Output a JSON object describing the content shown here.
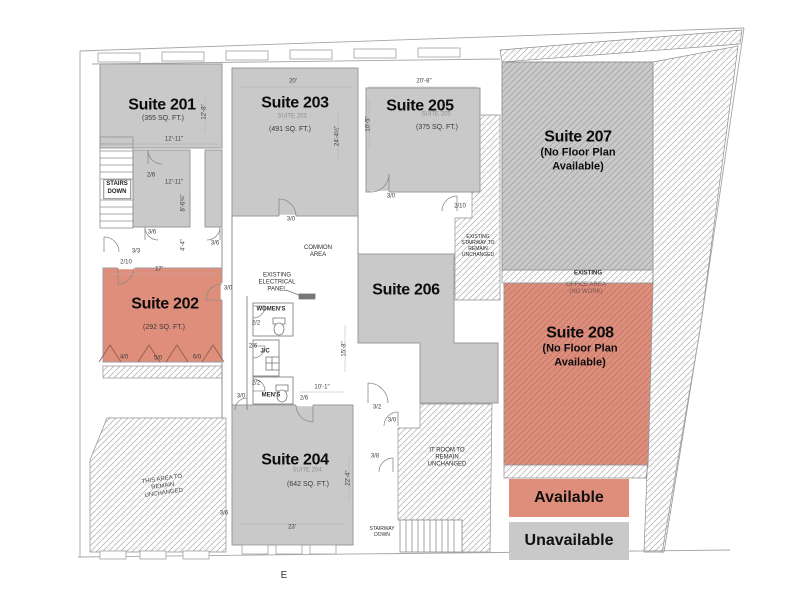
{
  "legend": {
    "available": "Available",
    "unavailable": "Unavailable"
  },
  "colors": {
    "available": "#E08E7C",
    "unavailable": "#C9C9C9"
  },
  "suites": {
    "s201": {
      "name": "Suite 201",
      "sqft": "(355 SQ. FT.)"
    },
    "s202": {
      "name": "Suite 202",
      "sqft": "(292 SQ. FT.)"
    },
    "s203": {
      "name": "Suite 203",
      "sub": "SUITE 203",
      "sqft": "(491 SQ. FT.)"
    },
    "s204": {
      "name": "Suite 204",
      "sub": "SUITE 204",
      "sqft": "(642 SQ. FT.)"
    },
    "s205": {
      "name": "Suite 205",
      "sub": "SUITE 205",
      "sqft": "(375 SQ. FT.)"
    },
    "s206": {
      "name": "Suite 206"
    },
    "s207": {
      "name": "Suite 207",
      "note": "(No Floor Plan\nAvailable)"
    },
    "s208": {
      "name": "Suite 208",
      "note": "(No Floor Plan\nAvailable)"
    }
  },
  "annotations": {
    "common_area": "COMMON\nAREA",
    "electrical_panel": "EXISTING\nELECTRICAL\nPANEL",
    "womens": "WOMEN'S",
    "janitor_closet": "J/C",
    "mens": "MEN'S",
    "stairs_down": "STAIRS\nDOWN",
    "existing_stairway": "EXISTING\nSTAIRWAY TO\nREMAIN\nUNCHANGED",
    "existing_label": "EXISTING",
    "office_area": "OFFICE AREA\n(NO WORK)",
    "it_room": "IT ROOM TO\nREMAIN\nUNCHANGED",
    "area_unchanged": "THIS AREA TO\nREMAIN\nUNCHANGED",
    "stairway_down": "STAIRWAY\nDOWN",
    "east_marker": "E"
  },
  "dims": {
    "d1": "12'-8\"",
    "d2": "12'-11\"",
    "d3": "2/6",
    "d4": "12'-11\"",
    "d5": "8'-6¾\"",
    "d6": "3/6",
    "d7": "4'-4\"",
    "d8": "3/6",
    "d9": "3/3",
    "d10": "20'",
    "d11": "24'-4½\"",
    "d12": "10'-5\"",
    "d13": "20'-8\"",
    "d14": "3/0",
    "d15": "2/10",
    "d16": "3/0",
    "d17": "2/10",
    "d18": "17'",
    "d19": "3/0",
    "d20": "4/0",
    "d21": "5/0",
    "d22": "6/0",
    "d23": "2/2",
    "d24": "2/6",
    "d25": "2/2",
    "d26": "3/0",
    "d27": "2/6",
    "d28": "15'-8\"",
    "d29": "10'-1\"",
    "d30": "3/2",
    "d31": "3/0",
    "d32": "3/8",
    "d33": "22'-4\"",
    "d34": "23'",
    "d35": "3/6"
  }
}
